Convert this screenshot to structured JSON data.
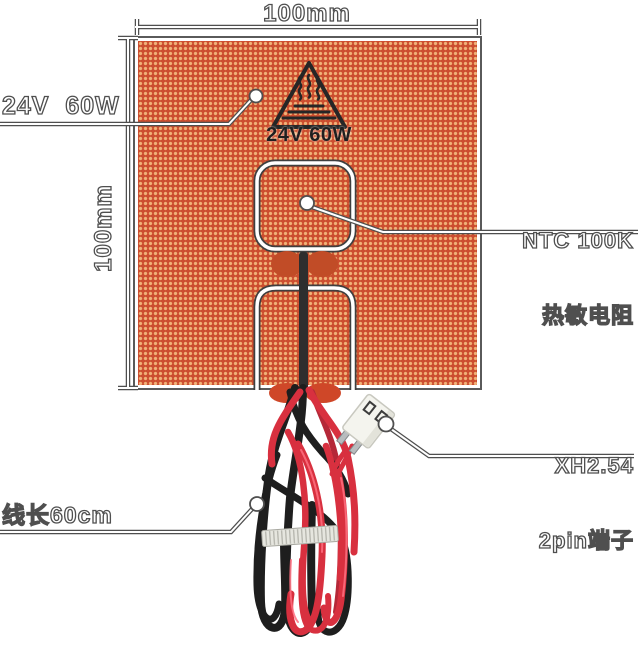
{
  "image": {
    "background": "#ffffff",
    "pad": {
      "base_color": "#cc4e2f",
      "dot_color": "#f0b177",
      "border_color": "#ffffff"
    },
    "dimensions": {
      "width": "100mm",
      "height": "100mm"
    },
    "callouts": {
      "power": "24V  60W",
      "thermistor": [
        "NTC 100K",
        "热敏电阻"
      ],
      "connector": [
        "XH2.54",
        "2pin端子"
      ],
      "cable_length": "线长60cm"
    },
    "pad_marking": {
      "icon": "heat-warning-triangle-icon",
      "text": "24V 60W"
    },
    "icons": [
      "heat-warning-triangle-icon",
      "callout-dot",
      "callout-circle"
    ],
    "wires": {
      "red_color": "#d8303f",
      "black_color": "#1e1e1e",
      "cable_tie_color": "#e6e6df",
      "connector_color": "#f4f4ee"
    },
    "annotation_color": "#4f4f4f"
  }
}
